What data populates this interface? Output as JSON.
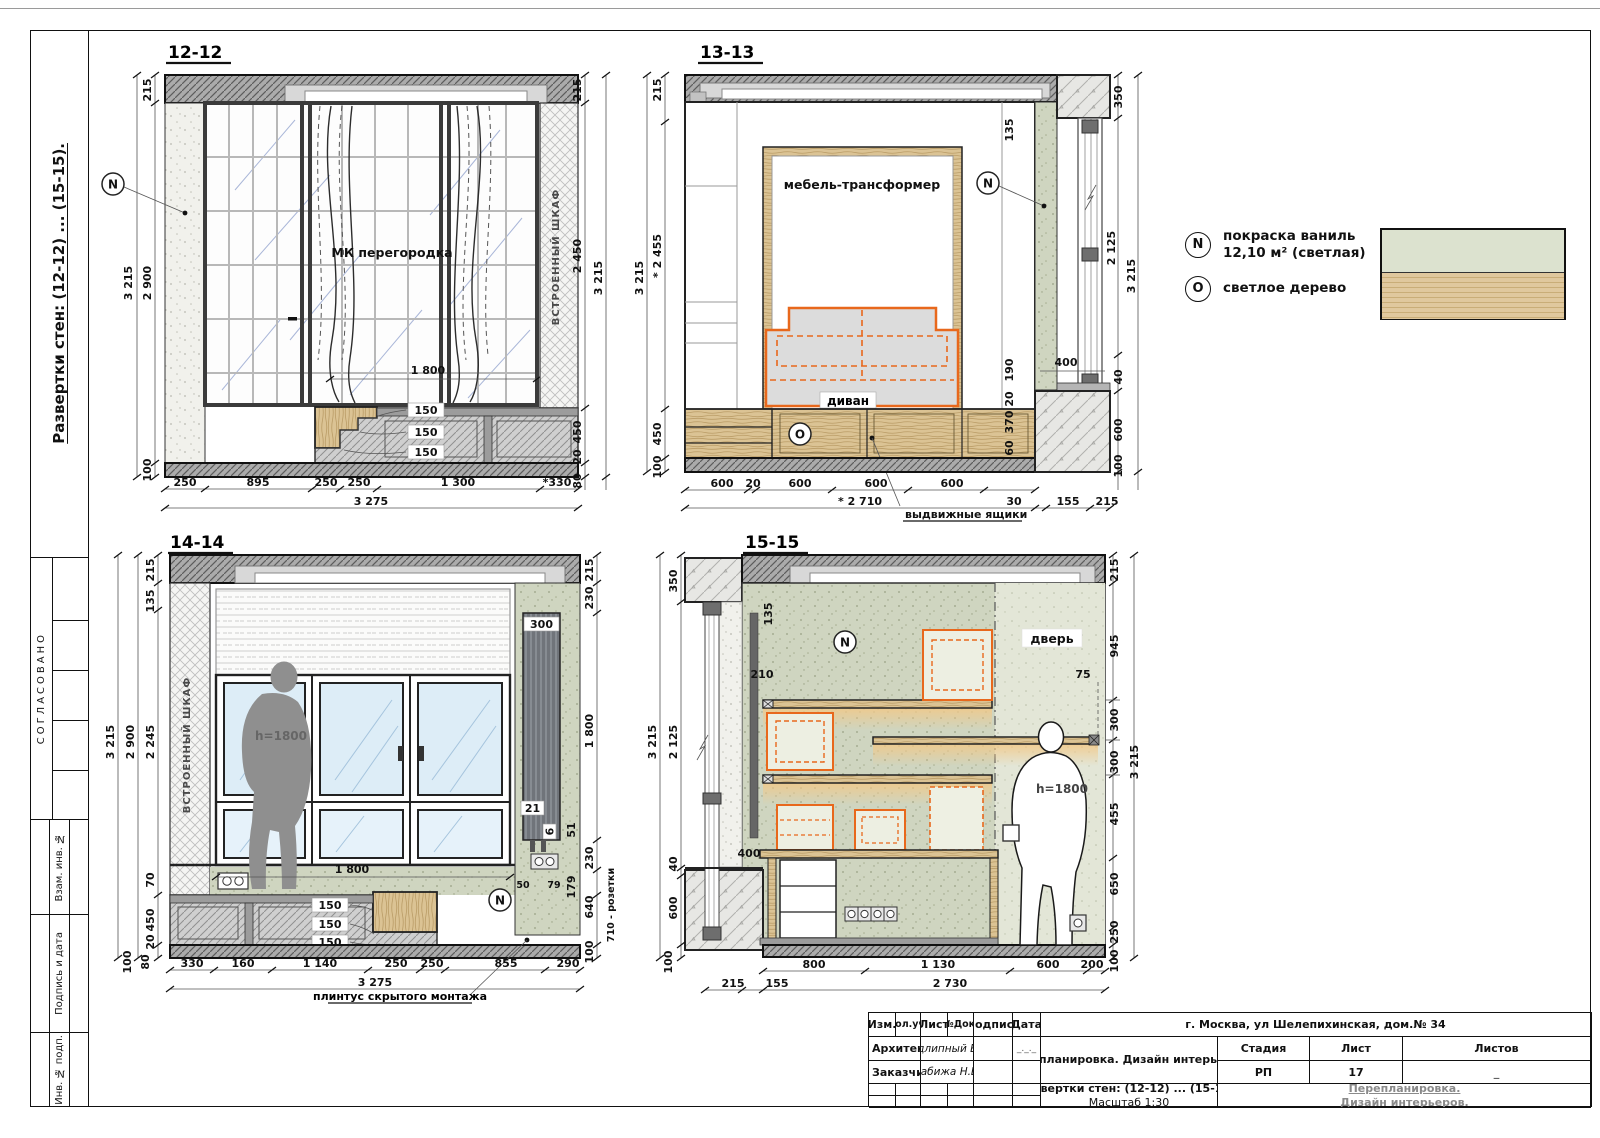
{
  "frame": {
    "side_title": "Развертки стен: (12-12) ... (15-15).",
    "approved": "СОГЛАСОВАНО",
    "cell1": "Взам. инв. №",
    "cell2": "Подпись и дата",
    "cell3": "Инв. № подп."
  },
  "legend": {
    "n_symbol": "N",
    "n_line1": "покраска ваниль",
    "n_line2": "12,10 м² (светлая)",
    "o_symbol": "O",
    "o_text": "светлое дерево",
    "paint_color": "#dce2cf",
    "wood_color": "#dcc496",
    "accent_orange": "#e8681c"
  },
  "d12": {
    "title": "12-12",
    "partition_label": "МК перегородка",
    "wardrobe_label": "ВСТРОЕННЫЙ ШКАФ",
    "marker": "N",
    "dim_1800": "1 800",
    "steps": [
      "150",
      "150",
      "150"
    ],
    "left": [
      "215",
      "3 215",
      "2 900",
      "100"
    ],
    "right": [
      "215",
      "2 450",
      "3 215",
      "450",
      "20",
      "80"
    ],
    "bottom": [
      "250",
      "895",
      "250",
      "250",
      "1 300",
      "*330"
    ],
    "total": "3 275"
  },
  "d13": {
    "title": "13-13",
    "bed_label": "мебель-трансформер",
    "sofa_label": "диван",
    "marker_n": "N",
    "marker_o": "O",
    "left": [
      "215",
      "* 2 455",
      "3 215",
      "450",
      "100"
    ],
    "inner": [
      "135",
      "190",
      "20",
      "370",
      "60"
    ],
    "dim_400": "400",
    "right": [
      "350",
      "2 125",
      "3 215",
      "40",
      "600",
      "100"
    ],
    "bottom": [
      "600",
      "20",
      "600",
      "600",
      "600"
    ],
    "bottom2": [
      "* 2 710",
      "30",
      "155",
      "215"
    ],
    "leader": "выдвижные ящики"
  },
  "d14": {
    "title": "14-14",
    "wardrobe_label": "ВСТРОЕННЫЙ ШКАФ",
    "h_label": "h=1800",
    "marker": "N",
    "rad_w": "300",
    "rad_a": "21",
    "rad_b": "6",
    "dim_1800": "1 800",
    "steps": [
      "150",
      "150",
      "150"
    ],
    "left": [
      "215",
      "135",
      "2 245",
      "2 900",
      "3 215",
      "70",
      "450",
      "20",
      "80",
      "100"
    ],
    "right": [
      "215",
      "230",
      "1 800",
      "51",
      "230",
      "179",
      "640",
      "100"
    ],
    "small": [
      "50",
      "79"
    ],
    "sockets_label": "710 - розетки",
    "bottom": [
      "330",
      "160",
      "1 140",
      "250",
      "250",
      "855",
      "290"
    ],
    "total": "3 275",
    "leader": "плинтус скрытого монтажа"
  },
  "d15": {
    "title": "15-15",
    "door_label": "дверь",
    "h_label": "h=1800",
    "marker": "N",
    "dim_210": "210",
    "dim_400": "400",
    "dim_75": "75",
    "dim_135": "135",
    "left": [
      "350",
      "2 125",
      "3 215",
      "40",
      "600",
      "100"
    ],
    "right": [
      "215",
      "945",
      "300",
      "300",
      "3 215",
      "455",
      "650",
      "250",
      "100"
    ],
    "bottom": [
      "800",
      "1 130",
      "600",
      "200"
    ],
    "bottom2": [
      "215",
      "155",
      "2 730"
    ]
  },
  "title_block": {
    "headers": [
      "Изм.",
      "Кол.уч.",
      "Лист",
      "№Док.",
      "Подпись",
      "Дата"
    ],
    "address": "г. Москва, ул Шелепихинская, дом.№ 34",
    "architect_label": "Архитектор",
    "architect_name": "Подлипный В.В.",
    "client_label": "Заказчик",
    "client_name": "Дабижа Н.В.",
    "date_placeholder": "_._._",
    "project": "Перепланировка. Дизайн интерьеров.",
    "stage_label": "Стадия",
    "sheet_label": "Лист",
    "sheets_label": "Листов",
    "stage_value": "РП",
    "sheet_value": "17",
    "sheets_value": "_",
    "doc_line1": "Развертки стен: (12-12) ... (15-15).",
    "doc_line2": "Масштаб 1:30",
    "org_line1": "Перепланировка.",
    "org_line2": "Дизайн интерьеров."
  }
}
